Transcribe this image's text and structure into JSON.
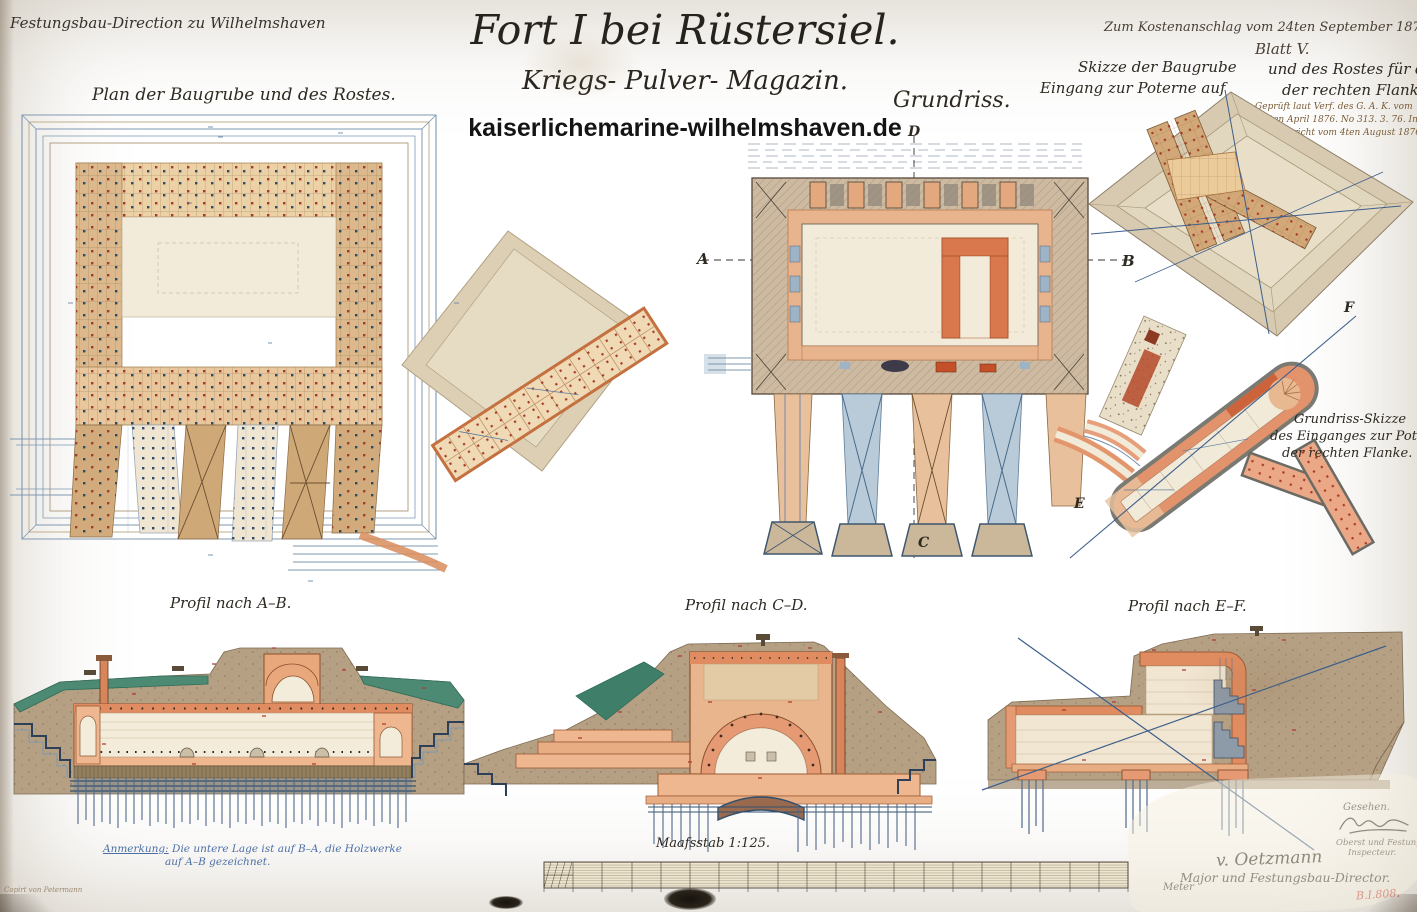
{
  "colors": {
    "paper": "#e6d8ba",
    "ink": "#2e2a22",
    "blue_ink": "#3d5f8c",
    "salmon_masonry": "#e8a47c",
    "orange_strong": "#d96f42",
    "timber": "#d2a878",
    "earth": "#b5a084",
    "grass_green": "#4d8a74",
    "stamp_red": "#c0392b"
  },
  "header": {
    "office_note": "Festungsbau-Direction zu Wilhelmshaven",
    "title": "Fort I bei Rüstersiel.",
    "subtitle": "Kriegs- Pulver- Magazin.",
    "watermark": "kaiserlichemarine-wilhelmshaven.de"
  },
  "top_right": {
    "ref_line1": "Zum Kostenanschlag vom 24ten September 1875 gehörig",
    "ref_line2": "Blatt V.",
    "sketch_title_l1a": "Skizze der Baugrube",
    "sketch_title_l1b": "und des Rostes für den",
    "sketch_title_l2a": "Eingang zur Poterne auf",
    "sketch_title_l2b": "der rechten Flanke.",
    "note1": "Geprüft laut Verf. des G. A. K. vom",
    "note2": "15ten April 1876. No 313. 3. 76. Ing.",
    "note3": "Zum Bericht vom 4ten August 1876."
  },
  "plans": {
    "baugrube_title": "Plan der Baugrube und des Rostes.",
    "grundriss_title": "Grundriss.",
    "poterne_title_l1": "Grundriss-Skizze",
    "poterne_title_l2": "des Einganges zur Poterne",
    "poterne_title_l3": "der rechten Flanke."
  },
  "sections": {
    "a": "A",
    "b": "B",
    "c": "C",
    "d": "D",
    "e": "E",
    "f": "F"
  },
  "profiles": {
    "ab_label": "Profil nach A–B.",
    "cd_label": "Profil nach C–D.",
    "ef_label": "Profil nach E–F."
  },
  "scale": {
    "label": "Maafsstab 1:125.",
    "unit": "Meter"
  },
  "footer": {
    "remark_intro": "Anmerkung:",
    "remark_l1": " Die untere Lage ist auf B–A, die Holzwerke",
    "remark_l2": "auf A–B gezeichnet.",
    "copy_note": "Copirt von Petermann",
    "seen": "Gesehen.",
    "inspector_title_l1": "Oberst und Festungs-",
    "inspector_title_l2": "Inspecteur.",
    "director_sig": "v. Oetzmann",
    "director_title": "Major und Festungsbau-Director.",
    "stamp": "B.I.808."
  }
}
